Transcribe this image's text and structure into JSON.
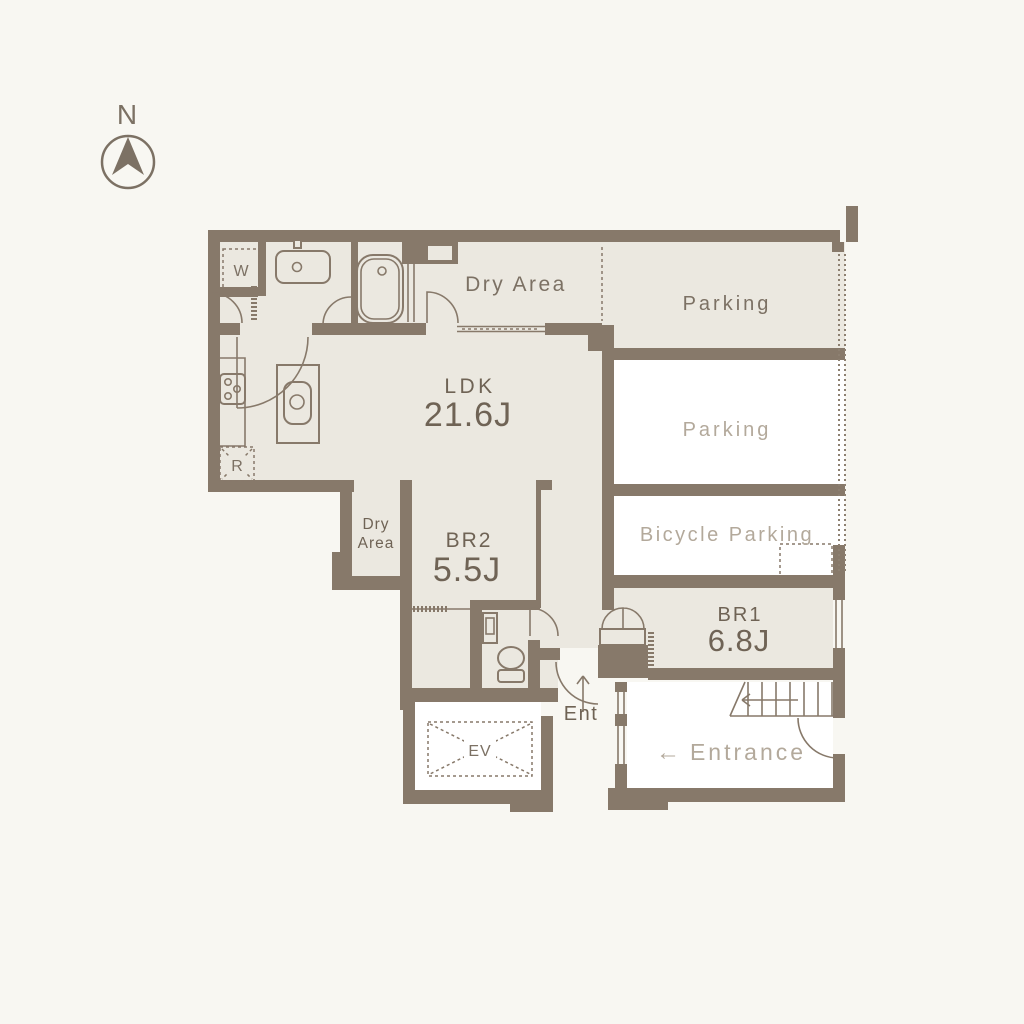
{
  "compass": {
    "label": "N"
  },
  "labels": {
    "dry_area_top": "Dry Area",
    "parking_upper": "Parking",
    "parking_lower": "Parking",
    "bicycle_parking": "Bicycle Parking",
    "ldk_name": "LDK",
    "ldk_size": "21.6J",
    "dry_area_small_1": "Dry",
    "dry_area_small_2": "Area",
    "br2_name": "BR2",
    "br2_size": "5.5J",
    "br1_name": "BR1",
    "br1_size": "6.8J",
    "ent": "Ent",
    "entrance_arrow": "←",
    "entrance": "Entrance",
    "washer": "W",
    "refrigerator": "R",
    "elevator": "EV"
  },
  "colors": {
    "background": "#f8f7f2",
    "wall": "#87796a",
    "room_fill": "#ebe8e0",
    "text_dark": "#6f6355",
    "text_light": "#b3a99b"
  }
}
